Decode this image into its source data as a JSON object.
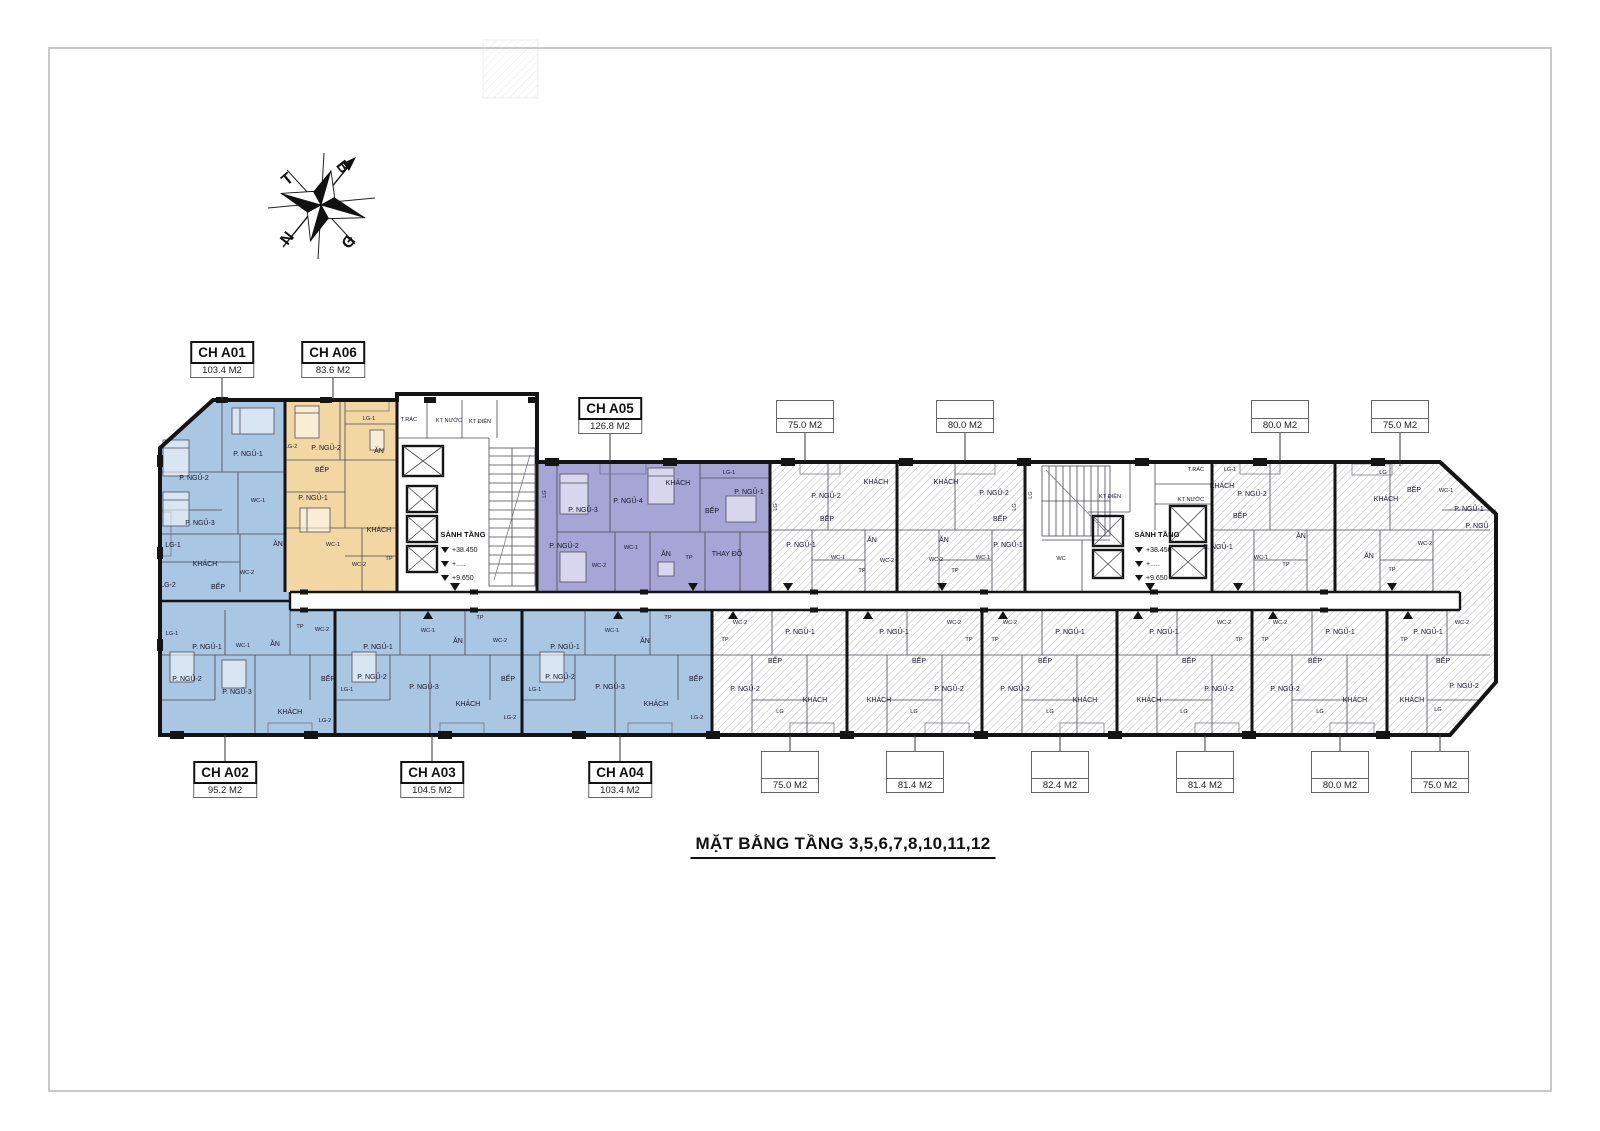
{
  "title": "MẶT BẰNG TẦNG 3,5,6,7,8,10,11,12",
  "compass": {
    "north": "B",
    "south": "N",
    "east": "Đ",
    "west": "T"
  },
  "colors": {
    "unit_blue": "#a9c6e3",
    "unit_orange": "#f3d7a2",
    "unit_purple": "#a7a4d6",
    "wall": "#141414",
    "hatch_line": "#9a9a9a",
    "frame": "#c9c9c9"
  },
  "apartments": [
    {
      "code": "CH A01",
      "area": "103.4 M2"
    },
    {
      "code": "CH A06",
      "area": "83.6 M2"
    },
    {
      "code": "CH A05",
      "area": "126.8 M2"
    },
    {
      "code": "CH A02",
      "area": "95.2 M2"
    },
    {
      "code": "CH A03",
      "area": "104.5 M2"
    },
    {
      "code": "CH A04",
      "area": "103.4 M2"
    }
  ],
  "top_units": [
    {
      "area": "75.0 M2"
    },
    {
      "area": "80.0 M2"
    },
    {
      "area": "80.0 M2"
    },
    {
      "area": "75.0 M2"
    }
  ],
  "bottom_units": [
    {
      "area": "75.0 M2"
    },
    {
      "area": "81.4 M2"
    },
    {
      "area": "82.4 M2"
    },
    {
      "area": "81.4 M2"
    },
    {
      "area": "80.0 M2"
    },
    {
      "area": "75.0 M2"
    }
  ],
  "core": {
    "lobby": "SẢNH TẦNG",
    "level_upper": "+38.450",
    "level_mid": "+.....",
    "level_lower": "+9.650",
    "trash": "T.RÁC",
    "water_tech": "KT NƯỚC",
    "electric_tech": "KT ĐIỆN"
  },
  "rooms": {
    "bed1": "P. NGỦ-1",
    "bed2": "P. NGỦ-2",
    "bed3": "P. NGỦ-3",
    "bed4": "P. NGỦ-4",
    "bed": "P. NGỦ",
    "living": "KHÁCH",
    "kitchen": "BẾP",
    "dining": "ĂN",
    "wc": "WC",
    "wc1": "WC-1",
    "wc2": "WC-2",
    "lg": "LG",
    "lg1": "LG-1",
    "lg2": "LG-2",
    "tp": "TP",
    "dressing": "THAY ĐỒ"
  }
}
